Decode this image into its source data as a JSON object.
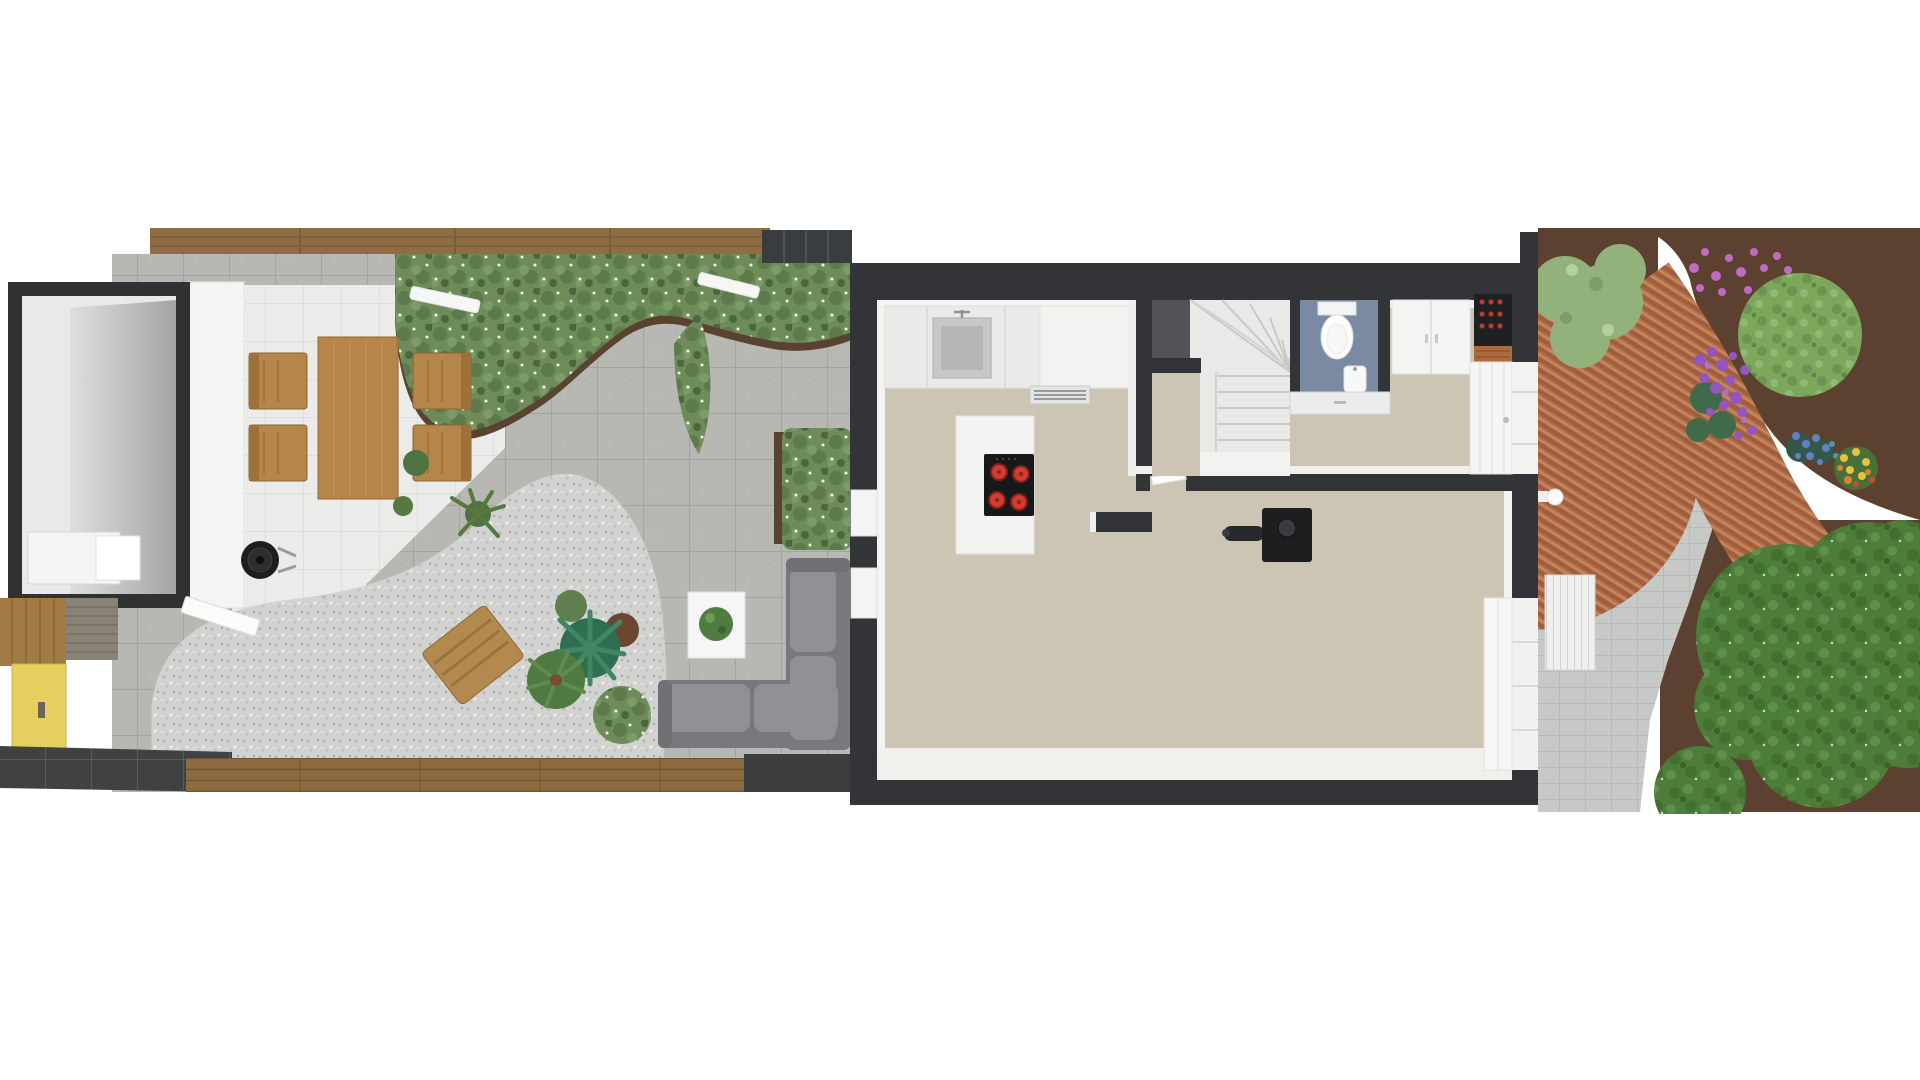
{
  "scene": {
    "description": "Top-down 3D architectural floor plan render: back garden (left), ground floor of a narrow terraced house (center), front garden with brick path (right)",
    "background": "#ffffff"
  },
  "palette": {
    "wall_dark": "#323437",
    "floor_beige": "#cdc5b4",
    "wall_face_white": "#f3f2ef",
    "counter_white": "#eaeae9",
    "island_white": "#f3f3f2",
    "cooktop_black": "#17181a",
    "burner_red": "#d23b2f",
    "stairs_white": "#e9e9e8",
    "bath_floor_blue": "#7b8aa3",
    "porcelain_white": "#fbfbfb",
    "wardrobe_white": "#f4f4f3",
    "wine_rack_black": "#1f2022",
    "bottle_red": "#c23a2e",
    "shelf_copper": "#ad6a3e",
    "stove_black": "#1d1e20",
    "sofa_grey": "#77797c",
    "cushion_grey": "#8f9194",
    "table_white": "#f6f6f6",
    "plant_green": "#4e7d3f",
    "wood_furniture": "#b5854a",
    "lounger_wood": "#b38950",
    "fence_wood": "#8f6d44",
    "deck_wood": "#8b6a41",
    "gate_yellow": "#e6cf5e",
    "hedge_green": "#6d8c5a",
    "soil_brown": "#59422f",
    "gravel_grey": "#d2d3d1",
    "paver_grey": "#b7b8b4",
    "tile_white": "#ebebe9",
    "brick_red": "#b3724e",
    "front_soil_brown": "#5d4130",
    "front_paving_grey": "#c6c9c6",
    "dark_tile_path": "#3f4143",
    "radiator_white": "#efefed",
    "bush_light_green": "#93b27b",
    "round_tree_green": "#7da75b",
    "tree_green": "#4e7c3a",
    "bbq_black": "#1d1e20",
    "shed_wall_dark": "#2f3133",
    "flower_purple": "#9455c0",
    "flower_pink": "#c06ac2",
    "flower_blue": "#5d83c6",
    "flower_yellow": "#e7c23d",
    "flower_orange": "#d8832f"
  },
  "backyard": {
    "objects": [
      {
        "name": "garden-shed",
        "label": "shed with storage cabinet"
      },
      {
        "name": "shed-door",
        "label": "open shed door"
      },
      {
        "name": "timber-fence",
        "label": "wooden boundary fence"
      },
      {
        "name": "patio",
        "label": "white tiled patio"
      },
      {
        "name": "dining-set",
        "label": "wooden table with four chairs"
      },
      {
        "name": "kettle-bbq",
        "label": "round black barbecue"
      },
      {
        "name": "hedge",
        "label": "green planting bed"
      },
      {
        "name": "gravel-patch",
        "label": "rounded gravel area"
      },
      {
        "name": "lounger",
        "label": "wooden lounge chair"
      },
      {
        "name": "planters",
        "label": "agave, shrubs and potted plants"
      },
      {
        "name": "corner-sofa",
        "label": "grey L-shaped garden sofa"
      },
      {
        "name": "coffee-table",
        "label": "white table with plant"
      },
      {
        "name": "deck-edge",
        "label": "timber deck boards"
      },
      {
        "name": "side-gate",
        "label": "yellow garden gate"
      }
    ]
  },
  "house": {
    "rooms": [
      {
        "name": "kitchen",
        "features": [
          "counter with sink",
          "extractor grille",
          "island with 4-zone hob"
        ]
      },
      {
        "name": "staircase",
        "features": [
          "winder stairs"
        ]
      },
      {
        "name": "toilet-room",
        "features": [
          "toilet",
          "hand basin",
          "blue floor"
        ]
      },
      {
        "name": "hallway",
        "features": [
          "wardrobe",
          "wine rack",
          "copper shelf",
          "front door"
        ]
      },
      {
        "name": "living-room",
        "features": [
          "wood stove with flue pipe",
          "garden window"
        ]
      }
    ]
  },
  "front_garden": {
    "objects": [
      {
        "name": "brick-path",
        "label": "curved red brick path"
      },
      {
        "name": "block-paving",
        "label": "grey block paving"
      },
      {
        "name": "flower-beds",
        "label": "soil beds with purple, pink, blue and yellow flowers"
      },
      {
        "name": "round-tree",
        "label": "clipped round tree"
      },
      {
        "name": "large-trees",
        "label": "large green trees"
      },
      {
        "name": "radiator-bench",
        "label": "white slatted unit"
      },
      {
        "name": "rain-pipe",
        "label": "white drain pipe"
      }
    ]
  }
}
